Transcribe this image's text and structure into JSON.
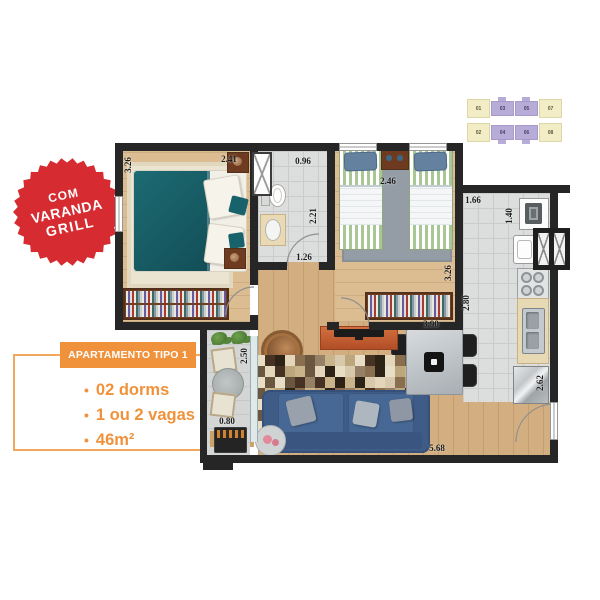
{
  "colors": {
    "accent": "#f0923b",
    "accent_light": "#f2a85c",
    "badge_red": "#d62b31",
    "keyplan_highlight": "#f2edc4",
    "keyplan_other": "#b7abd7",
    "wall": "#262626",
    "wood_floor": "#d2ae80",
    "tile_floor": "#dcdedd",
    "bed_teal": "#1d6b73",
    "sofa_blue": "#3f5c87"
  },
  "badge": {
    "line1": "COM",
    "line2": "VARANDA",
    "line3": "GRILL"
  },
  "keyplan": {
    "rows": [
      [
        "01",
        "03",
        "05",
        "07"
      ],
      [
        "02",
        "04",
        "06",
        "08"
      ]
    ],
    "highlighted": [
      "01",
      "02",
      "07",
      "08"
    ]
  },
  "info": {
    "title": "APARTAMENTO TIPO 1",
    "bullet_char": "•",
    "bullets": [
      "02 dorms",
      "1 ou 2 vagas",
      "46m²"
    ]
  },
  "floorplan": {
    "dimensions": [
      {
        "text": "3.26",
        "x": 13,
        "y": 25,
        "v": true
      },
      {
        "text": "2.41",
        "x": 114,
        "y": 19,
        "v": false
      },
      {
        "text": "0.96",
        "x": 188,
        "y": 21,
        "v": false
      },
      {
        "text": "2.21",
        "x": 198,
        "y": 76,
        "v": true
      },
      {
        "text": "1.26",
        "x": 189,
        "y": 117,
        "v": false
      },
      {
        "text": "2.46",
        "x": 273,
        "y": 41,
        "v": false
      },
      {
        "text": "3.26",
        "x": 333,
        "y": 133,
        "v": true
      },
      {
        "text": "1.66",
        "x": 358,
        "y": 60,
        "v": false
      },
      {
        "text": "1.40",
        "x": 394,
        "y": 76,
        "v": true
      },
      {
        "text": "2.80",
        "x": 351,
        "y": 163,
        "v": true
      },
      {
        "text": "2.62",
        "x": 425,
        "y": 243,
        "v": true
      },
      {
        "text": "2.50",
        "x": 129,
        "y": 216,
        "v": true
      },
      {
        "text": "0.80",
        "x": 112,
        "y": 281,
        "v": false
      },
      {
        "text": "3.90",
        "x": 316,
        "y": 184,
        "v": false
      },
      {
        "text": "5.68",
        "x": 322,
        "y": 308,
        "v": false
      }
    ]
  }
}
